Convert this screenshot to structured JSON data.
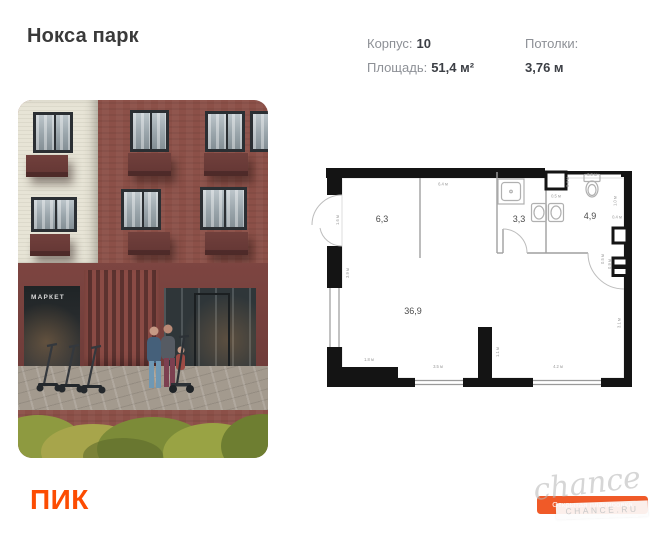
{
  "header": {
    "title": "Нокса парк",
    "specs": [
      {
        "label": "Корпус:",
        "value": "10"
      },
      {
        "label": "Площадь:",
        "value": "51,4 м²"
      },
      {
        "label": "Потолки:",
        "value": "3,76 м"
      }
    ]
  },
  "photo": {
    "market_sign": "МАРКЕТ"
  },
  "floorplan": {
    "rooms": [
      {
        "name": "hallway",
        "area": "6,3"
      },
      {
        "name": "bathroom",
        "area": "3,3"
      },
      {
        "name": "wc",
        "area": "4,9"
      },
      {
        "name": "living",
        "area": "36,9"
      }
    ],
    "dims": {
      "top": "6.4 м",
      "entry": "1.6 м",
      "left": "3.9 м",
      "bottom_left": "1.8 м",
      "bottom_mid": "3.5 м",
      "stub": "1.1 м",
      "bottom_right": "4.2 м",
      "right_low": "3.1 м",
      "door49_a": "0.5 м",
      "door49_b": "0.9 м",
      "shaft_w": "0.5 м",
      "shaft_h": "0.4 м",
      "wc_top": "0.9 м",
      "wc_h": "1.0 м",
      "wc_w": "0.4 м"
    }
  },
  "footer": {
    "logo": "ПИК",
    "badge": "Открытая планировка",
    "watermark": {
      "script": "chance",
      "domain": "CHANCE.RU"
    }
  },
  "colors": {
    "accent": "#FC4C02",
    "badge": "#F05A28"
  }
}
